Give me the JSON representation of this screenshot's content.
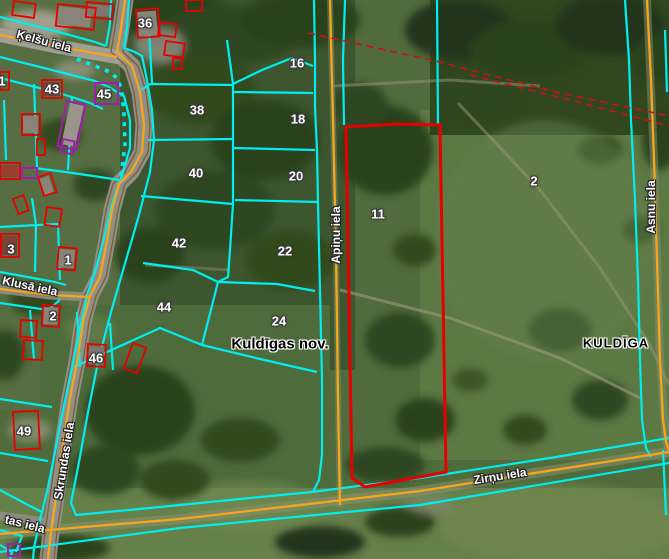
{
  "map": {
    "admin_labels": [
      {
        "text": "Kuldīgas nov.",
        "x": 280,
        "y": 344,
        "style": "municipality"
      },
      {
        "text": "KULDĪGA",
        "x": 616,
        "y": 343,
        "style": "city"
      }
    ],
    "street_labels": [
      {
        "text": "Ķelšu iela",
        "x": 44,
        "y": 41,
        "rot": 15
      },
      {
        "text": "Klusā iela",
        "x": 30,
        "y": 286,
        "rot": 12
      },
      {
        "text": "Skrundas iela",
        "x": 64,
        "y": 461,
        "rot": -81
      },
      {
        "text": "tas iela",
        "x": 25,
        "y": 524,
        "rot": 14
      },
      {
        "text": "Apiņu iela",
        "x": 336,
        "y": 235,
        "rot": -90
      },
      {
        "text": "Asnu iela",
        "x": 651,
        "y": 207,
        "rot": -90
      },
      {
        "text": "Zirņu iela",
        "x": 500,
        "y": 476,
        "rot": -9
      }
    ],
    "parcel_labels": [
      {
        "text": "36",
        "x": 145,
        "y": 23
      },
      {
        "text": "16",
        "x": 297,
        "y": 63
      },
      {
        "text": "43",
        "x": 52,
        "y": 89
      },
      {
        "text": "45",
        "x": 104,
        "y": 94
      },
      {
        "text": "38",
        "x": 197,
        "y": 110
      },
      {
        "text": "18",
        "x": 298,
        "y": 119
      },
      {
        "text": "40",
        "x": 196,
        "y": 173
      },
      {
        "text": "20",
        "x": 296,
        "y": 176
      },
      {
        "text": "11",
        "x": 378,
        "y": 214
      },
      {
        "text": "2",
        "x": 534,
        "y": 181
      },
      {
        "text": "42",
        "x": 179,
        "y": 243
      },
      {
        "text": "22",
        "x": 285,
        "y": 251
      },
      {
        "text": "3",
        "x": 11,
        "y": 249
      },
      {
        "text": "1",
        "x": 68,
        "y": 260
      },
      {
        "text": "44",
        "x": 164,
        "y": 307
      },
      {
        "text": "2",
        "x": 53,
        "y": 316
      },
      {
        "text": "24",
        "x": 279,
        "y": 321
      },
      {
        "text": "46",
        "x": 96,
        "y": 358
      },
      {
        "text": "49",
        "x": 24,
        "y": 431
      },
      {
        "text": "1",
        "x": 2,
        "y": 81
      }
    ],
    "colors": {
      "parcel_boundary_cyan": "#00eeee",
      "road_centerline_orange": "#f7a51c",
      "highlight_parcel_red": "#e60000",
      "building_outline_red": "#e60000",
      "building_outline_purple": "#a21caf",
      "cadastral_dashed_red": "#cc1111",
      "street_label_text": "#ffffff",
      "admin_label_text": "#000000"
    }
  }
}
